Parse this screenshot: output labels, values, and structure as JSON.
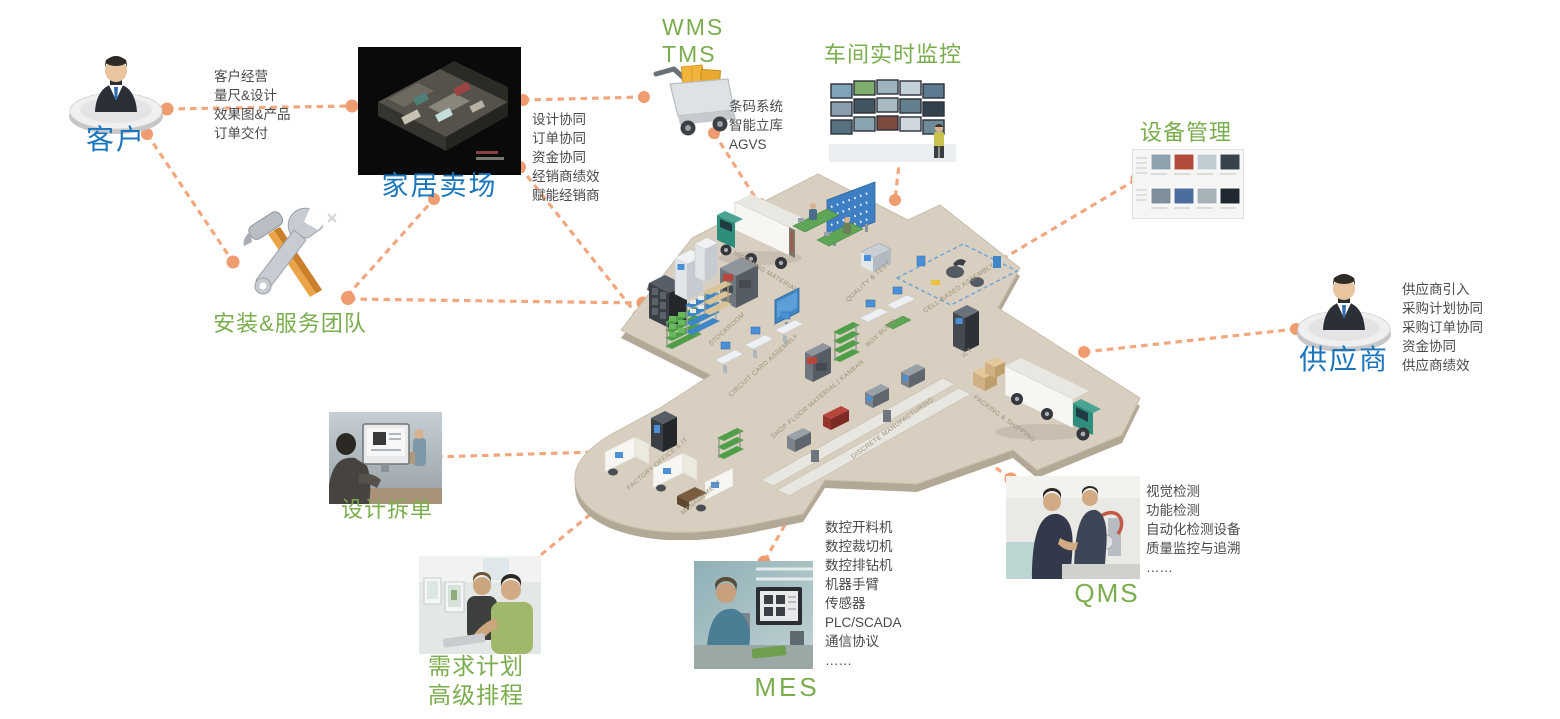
{
  "colors": {
    "connector_line": "#F2A77F",
    "connector_dot": "#EE9C70",
    "blue_label": "#1B75BC",
    "green_label": "#7BAD4F",
    "detail_text": "#4A4A4C",
    "platform": "#D8CFC0"
  },
  "nodes": {
    "customer": {
      "label": "客户",
      "details": [
        "客户经营",
        "量尺&设计",
        "效果图&产品",
        "订单交付"
      ]
    },
    "home_store": {
      "label": "家居卖场",
      "details": [
        "设计协同",
        "订单协同",
        "资金协同",
        "经销商绩效",
        "赋能经销商"
      ]
    },
    "install_team": {
      "label": "安装&服务团队"
    },
    "wms_tms": {
      "label": [
        "WMS",
        "TMS"
      ],
      "details": [
        "条码系统",
        "智能立库",
        "AGVS"
      ]
    },
    "workshop_monitoring": {
      "label": "车间实时监控"
    },
    "equipment_mgmt": {
      "label": "设备管理"
    },
    "supplier": {
      "label": "供应商",
      "details": [
        "供应商引入",
        "采购计划协同",
        "采购订单协同",
        "资金协同",
        "供应商绩效"
      ]
    },
    "design_split": {
      "label": "设计拆单"
    },
    "demand_planning": {
      "label": [
        "需求计划",
        "高级排程"
      ]
    },
    "mes": {
      "label": "MES",
      "details": [
        "数控开料机",
        "数控裁切机",
        "数控排钻机",
        "机器手臂",
        "传感器",
        "PLC/SCADA",
        "通信协议",
        "……"
      ]
    },
    "qms": {
      "label": "QMS",
      "details": [
        "视觉检测",
        "功能检测",
        "自动化检测设备",
        "质量监控与追溯",
        "……"
      ]
    }
  },
  "factory": {
    "zones": [
      "INCOMING MATERIAL",
      "STOCKROOM",
      "QUALITY & TEST",
      "CELL-BASED ASSEMBLY",
      "CIRCUIT CARD ASSEMBLY",
      "SHOP FLOOR MATERIAL | KANBAN",
      "BOX BUILD",
      "ICT",
      "DISCRETE MANUFACTURING",
      "PACKING & SHIPPING",
      "FACTORY OFFICE & IT",
      "MANAGEMENT"
    ]
  }
}
